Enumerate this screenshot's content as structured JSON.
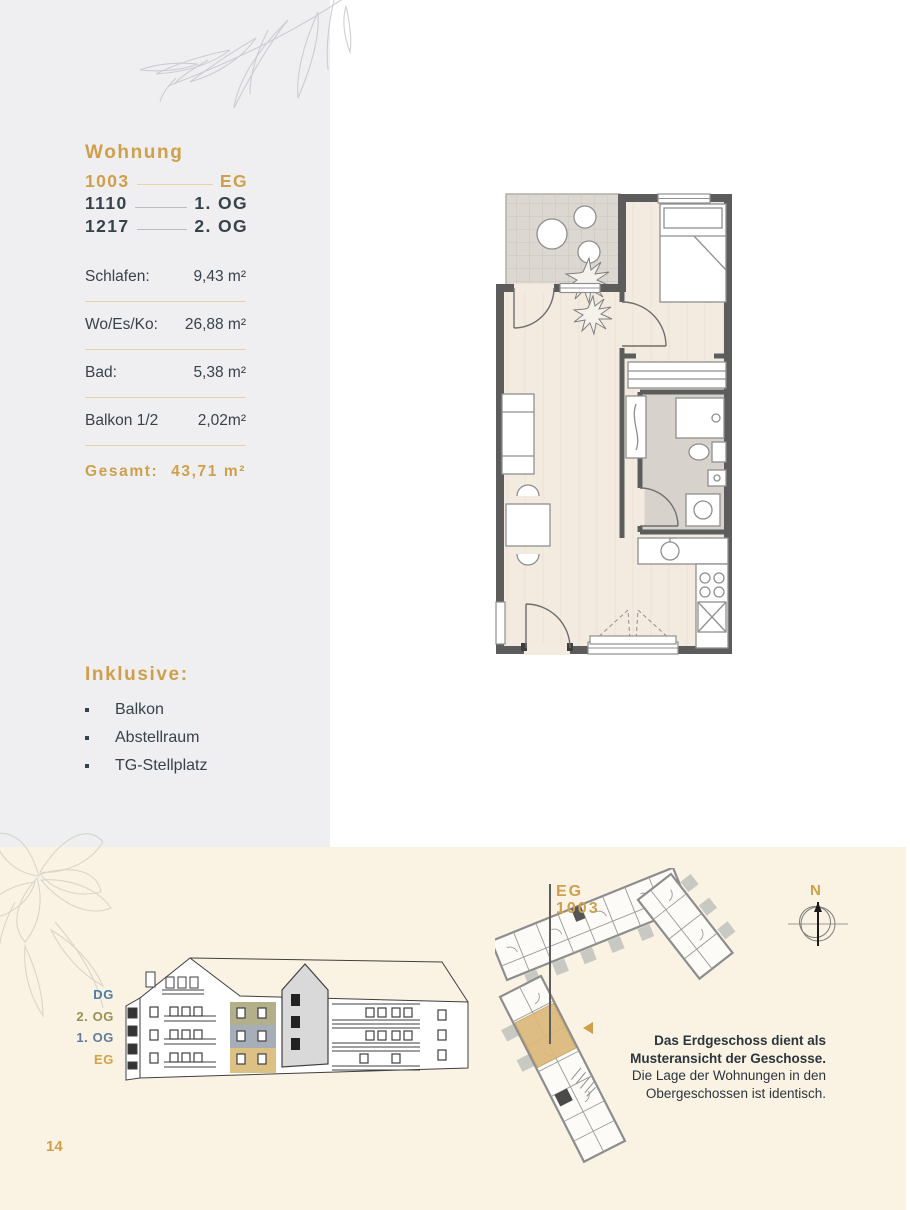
{
  "colors": {
    "gold": "#cfa04c",
    "slate": "#37424b",
    "panel_gray": "#efeff2",
    "cream": "#faf3e3",
    "divider_gold": "#e6d3a0",
    "highlight_eg": "#d9ba77",
    "highlight_og1": "#96a1ab",
    "highlight_og2": "#a4a176"
  },
  "sidebar": {
    "heading": "Wohnung",
    "units": [
      {
        "number": "1003",
        "floor": "EG"
      },
      {
        "number": "1110",
        "floor": "1. OG"
      },
      {
        "number": "1217",
        "floor": "2. OG"
      }
    ],
    "areas": [
      {
        "label": "Schlafen:",
        "value": "9,43 m²"
      },
      {
        "label": "Wo/Es/Ko:",
        "value": "26,88 m²"
      },
      {
        "label": "Bad:",
        "value": "5,38 m²"
      },
      {
        "label": "Balkon 1/2",
        "value": "2,02m²"
      }
    ],
    "total": {
      "label": "Gesamt:",
      "value": "43,71 m²"
    },
    "inclusive": {
      "heading": "Inklusive:",
      "items": [
        "Balkon",
        "Abstellraum",
        "TG-Stellplatz"
      ]
    }
  },
  "elevation": {
    "floor_labels": [
      {
        "label": "DG",
        "color": "#4e7ca8"
      },
      {
        "label": "2. OG",
        "color": "#9a9151"
      },
      {
        "label": "1. OG",
        "color": "#5f7d9b"
      },
      {
        "label": "EG",
        "color": "#d2a347"
      }
    ]
  },
  "site_plan": {
    "callout_line1": "EG",
    "callout_line2": "1003",
    "north_label": "N",
    "note_line1": "Das Erdgeschoss dient als",
    "note_line2": "Musteransicht der Geschosse.",
    "note_line3": "Die Lage der Wohnungen in den",
    "note_line4": "Obergeschossen ist identisch."
  },
  "page_number": "14"
}
